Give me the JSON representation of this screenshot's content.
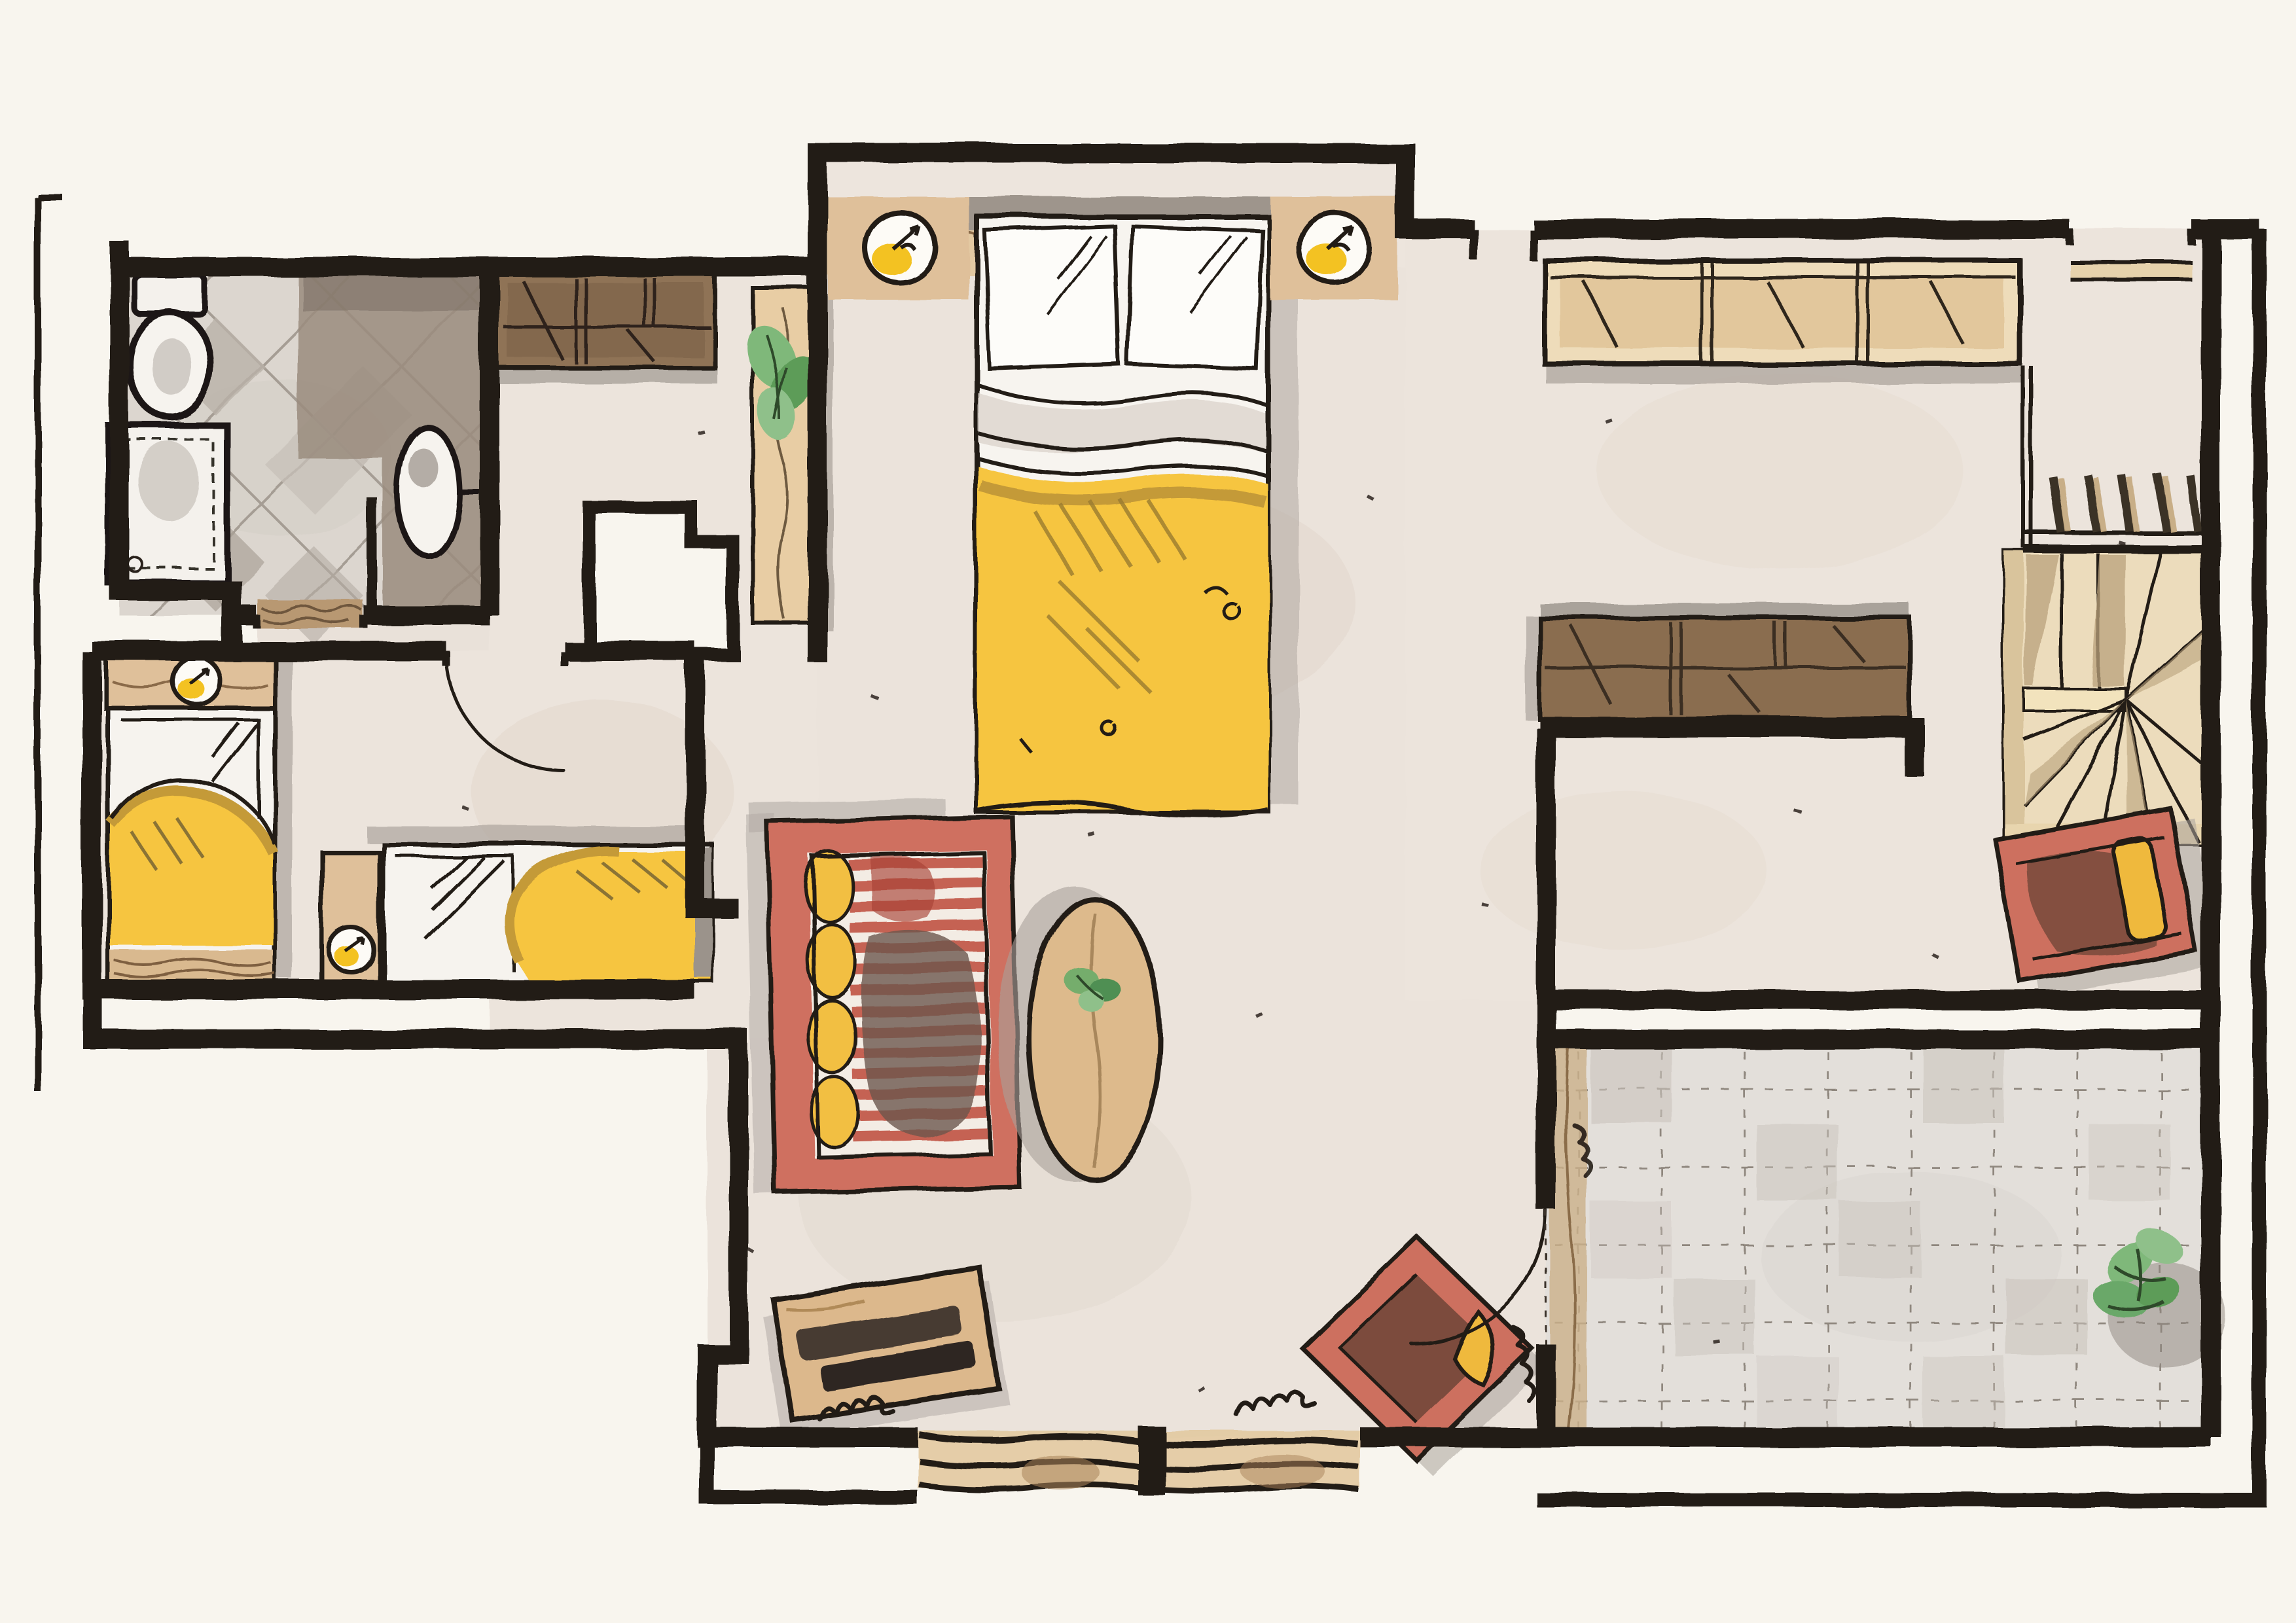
{
  "document": {
    "kind": "hand-drawn watercolor floor plan",
    "view": "top-down attic apartment",
    "visible_text": "none"
  },
  "palette": {
    "paper": "#f8f5ee",
    "floor": "#ebe3db",
    "terrace_floor": "#e3dfda",
    "wall_ink": "#211b15",
    "duvet_yellow": "#f5c53f",
    "duvet_mustard": "#c49a38",
    "lamp_yellow": "#f3c220",
    "sofa_red": "#cf7060",
    "sofa_stripe": "#bb5848",
    "chair_red": "#cd6f5e",
    "chair_inner": "#7c4b3e",
    "cushion_yellow": "#efb93d",
    "wood_tan": "#ddba8c",
    "wardrobe_beige": "#eedcba",
    "wardrobe_brown": "#8a6d50",
    "stair_tan": "#ecdcbc",
    "tile_gray": "#b9b1a8",
    "taupe": "#9a8c7e",
    "plant_green": "#7fb87a",
    "shadow_gray": "#b0a9a2"
  },
  "rooms": {
    "bathroom": {
      "label": "bathroom",
      "features": [
        "diamond-tile-floor",
        "toilet",
        "shower",
        "sink-oval",
        "door-threshold"
      ]
    },
    "kids_room": {
      "label": "kids-bedroom",
      "features": [
        "single-bed-vertical",
        "single-bed-horizontal",
        "two-bedside-lamps",
        "door-arc"
      ]
    },
    "hallway": {
      "label": "hallway",
      "features": [
        "brown-wardrobe",
        "plant-shelf",
        "chimney-block"
      ]
    },
    "master_area": {
      "label": "master-bed-area",
      "features": [
        "double-bed",
        "two-nightstand-lamps",
        "headboard-shelf"
      ]
    },
    "living": {
      "label": "living-area",
      "features": [
        "red-striped-sofa",
        "oval-coffee-table",
        "media-console",
        "diamond-armchair",
        "window-band",
        "terrace-door-arc"
      ]
    },
    "right_room": {
      "label": "dressing-guest-room",
      "features": [
        "long-wardrobe-row",
        "brown-sideboard",
        "stair-railing",
        "winder-stairs",
        "red-daybed",
        "top-window-sill"
      ]
    },
    "terrace": {
      "label": "terrace",
      "features": [
        "stone-tile-grid",
        "corner-plant",
        "wood-edge-strip"
      ]
    }
  },
  "annotations": {
    "door_arcs": 2,
    "radiator_squiggles": 3,
    "ink_speckles": 14
  }
}
